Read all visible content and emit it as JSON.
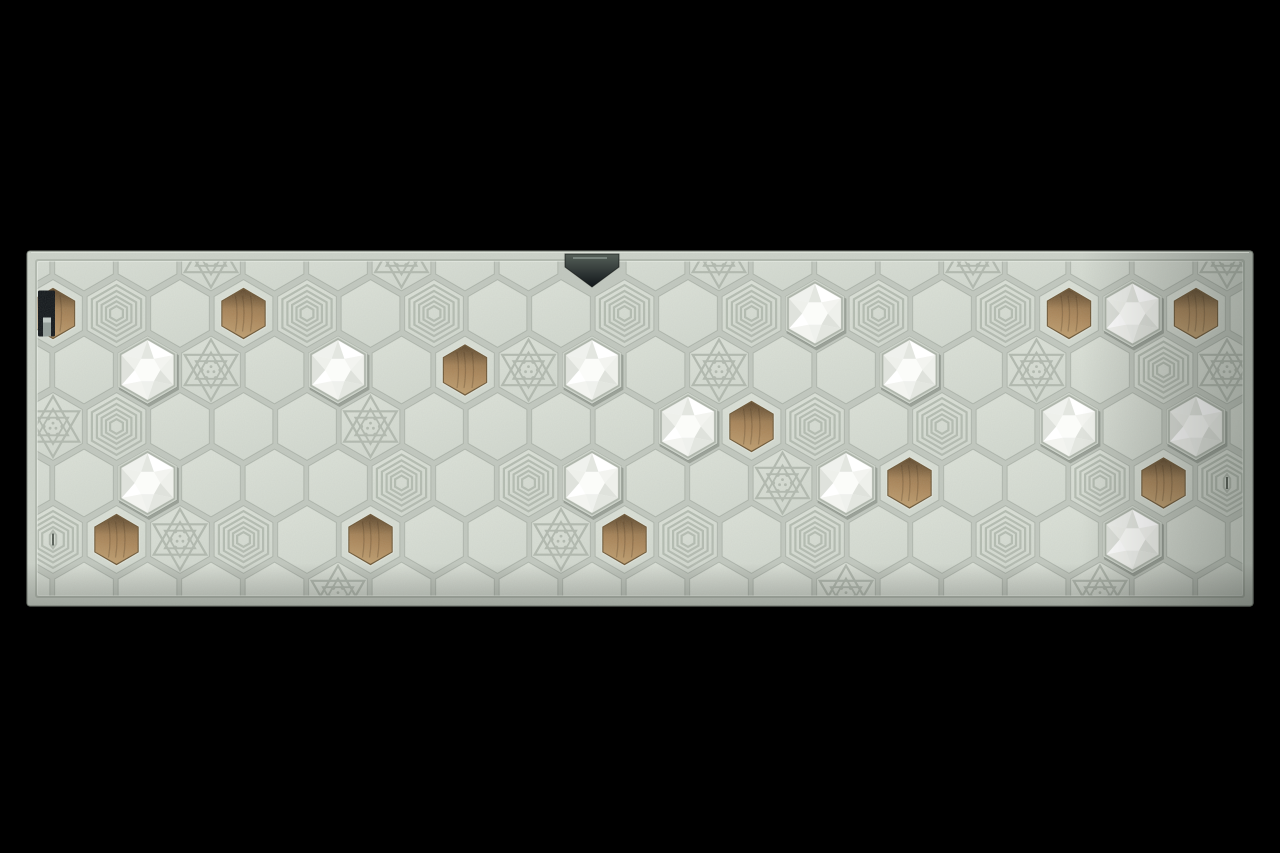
{
  "subject": "concrete hexagon tile wall panel with wooden inserts, white faceted ceramic tiles, engraved ring and hexagram patterns, a metal hanger notch and keyhole slot, photographed on black",
  "scene": {
    "background": "#000000",
    "panel": {
      "x": 27,
      "y": 251,
      "width": 1226,
      "height": 355,
      "inset": 9,
      "corner_radius": 3
    }
  },
  "palette": {
    "background": "#000000",
    "panel_face": "#ccd2c9",
    "grout": "#c2c8bf",
    "tile_light": "#dde2d9",
    "tile": "#d3d9d0",
    "groove": "#b2b9af",
    "groove_dark": "#99a096",
    "rim_highlight": "#e0e4db",
    "wood_dark": "#8a6c46",
    "wood_mid": "#ab8558",
    "wood_light": "#c2a171",
    "wood_rim": "#6b5433",
    "wood_grain": "rgba(84,60,32,0.30)",
    "white_tile": "#f7f8f5",
    "white_inner": "#fbfcf9",
    "white_facets": [
      "#ffffff",
      "#eef0eb",
      "#e3e6e0",
      "#f3f4f0",
      "#dfe2dc",
      "#eff1ed"
    ],
    "socket_shadow": "#aeb5ab",
    "white_drop_shadow": "rgba(44,52,44,0.25)",
    "metal_light": "#566059",
    "metal_dark": "#11161a",
    "metal_glint": "#87938c",
    "slot_black": "#101418",
    "pin_grey": "#939d99",
    "pin_cap": "#c2cac6",
    "edge_line": "#7e857b"
  },
  "board": {
    "hex_spacing_x": 63.5,
    "row_spacing_y": 56.5,
    "hex_radius": 34.5,
    "tile_types": [
      "plain",
      "rings",
      "star",
      "white",
      "wood",
      "wood_slot",
      "rings_slot",
      "hanger"
    ],
    "rows": [
      {
        "name": "top-edge-row",
        "y": 257,
        "x0": 20.5,
        "cells": [
          "plain",
          "plain",
          "plain",
          "star",
          "plain",
          "plain",
          "star",
          "plain",
          "plain",
          "hanger",
          "plain",
          "star",
          "plain",
          "plain",
          "plain",
          "star",
          "plain",
          "plain",
          "plain",
          "star"
        ]
      },
      {
        "name": "row-1",
        "y": 313.5,
        "x0": 53,
        "cells": [
          "wood_slot",
          "rings",
          "plain",
          "wood",
          "rings",
          "plain",
          "rings",
          "plain",
          "plain",
          "rings",
          "plain",
          "rings",
          "white",
          "rings",
          "plain",
          "rings",
          "wood",
          "white",
          "wood",
          "plain"
        ]
      },
      {
        "name": "row-2",
        "y": 370,
        "x0": 20.5,
        "cells": [
          "plain",
          "plain",
          "white",
          "star",
          "plain",
          "white",
          "plain",
          "wood",
          "star",
          "white",
          "plain",
          "star",
          "plain",
          "plain",
          "white",
          "plain",
          "star",
          "plain",
          "rings",
          "star"
        ]
      },
      {
        "name": "row-3",
        "y": 426.5,
        "x0": 53,
        "cells": [
          "star",
          "rings",
          "plain",
          "plain",
          "plain",
          "star",
          "plain",
          "plain",
          "plain",
          "plain",
          "white",
          "wood",
          "rings",
          "plain",
          "rings",
          "plain",
          "white",
          "plain",
          "white",
          "plain"
        ]
      },
      {
        "name": "row-4",
        "y": 483,
        "x0": 20.5,
        "cells": [
          "plain",
          "plain",
          "white",
          "plain",
          "plain",
          "plain",
          "rings",
          "plain",
          "rings",
          "white",
          "plain",
          "plain",
          "star",
          "white",
          "wood",
          "plain",
          "plain",
          "rings",
          "wood",
          "rings_slot"
        ]
      },
      {
        "name": "row-5",
        "y": 539.5,
        "x0": 53,
        "cells": [
          "rings_slot",
          "wood",
          "star",
          "rings",
          "plain",
          "wood",
          "plain",
          "plain",
          "star",
          "wood",
          "rings",
          "plain",
          "rings",
          "plain",
          "plain",
          "rings",
          "plain",
          "white",
          "plain",
          "plain"
        ]
      },
      {
        "name": "bottom-edge-row",
        "y": 596,
        "x0": 20.5,
        "cells": [
          "plain",
          "plain",
          "plain",
          "plain",
          "plain",
          "star",
          "plain",
          "plain",
          "plain",
          "plain",
          "plain",
          "plain",
          "plain",
          "star",
          "plain",
          "plain",
          "plain",
          "star",
          "plain",
          "plain"
        ]
      }
    ]
  }
}
